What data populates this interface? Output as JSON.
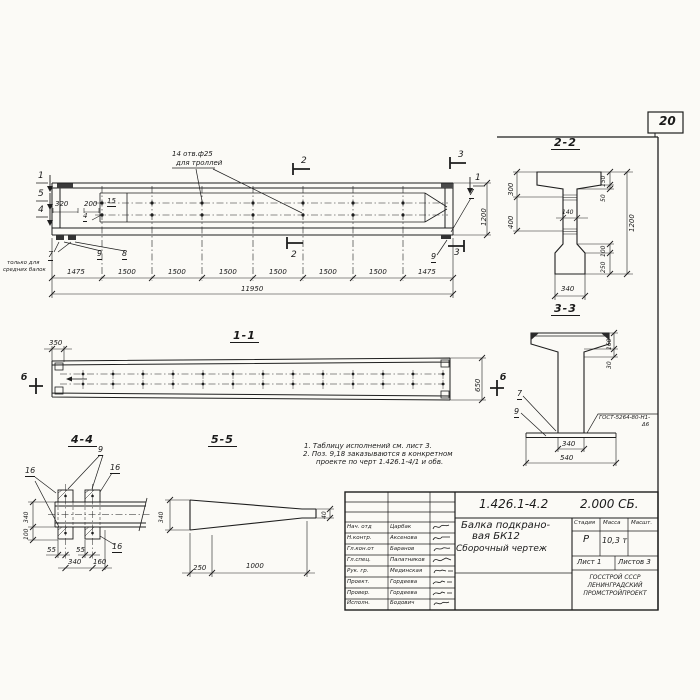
{
  "sheet": {
    "number": "20"
  },
  "notes": {
    "line1": "1. Таблицу исполнений см. лист 3.",
    "line2": "2. Поз. 9,18 заказываются в конкретном",
    "line3": "проекте по черт 1.426.1-4/1 и обв."
  },
  "facade": {
    "callout1": "14 отв.ф25",
    "callout2": "для троллей",
    "sec1": "1",
    "sec5": "5",
    "sec4": "4",
    "sec2": "2",
    "sec3": "3",
    "dim320": "320",
    "dim200": "200",
    "dim1200": "1200",
    "pos15": "15",
    "pos4": "4",
    "pos7l": "7",
    "pos7r": "7",
    "pos8": "8",
    "pos9l": "9",
    "pos9r": "9",
    "note7a": "только для",
    "note7b": "средних балок",
    "segments": [
      "1475",
      "1500",
      "1500",
      "1500",
      "1500",
      "1500",
      "1500",
      "1475"
    ],
    "total": "11950"
  },
  "section22": {
    "title": "2-2",
    "d300": "300",
    "d400": "400",
    "d140": "140",
    "d150": "150",
    "d50": "50",
    "d1200": "1200",
    "d100": "100",
    "d250": "250",
    "d340": "340"
  },
  "section33": {
    "title": "3-3",
    "d160": "160",
    "d30": "30",
    "pos7": "7",
    "pos9": "9",
    "weld1": "ГОСТ-5264-80-Н1-",
    "weld2": "Δ6",
    "d340": "340",
    "d540": "540"
  },
  "view11": {
    "title": "1-1",
    "d350": "350",
    "d650": "650",
    "marker": "б"
  },
  "view44": {
    "title": "4-4",
    "pos9": "9",
    "pos16": "16",
    "d340v": "340",
    "d100": "100",
    "d55": "55",
    "d340h": "340",
    "d160": "160"
  },
  "view55": {
    "title": "5-5",
    "d340": "340",
    "d40": "40",
    "d250": "250",
    "d1000": "1000"
  },
  "titleblock": {
    "doc_number": "1.426.1-4.2",
    "doc_code": "2.000 СБ.",
    "title1": "Балка подкрано-",
    "title2": "вая БК12",
    "title3": "Сборочный чертеж",
    "stage_label": "Стадия",
    "mass_label": "Масса",
    "scale_label": "Масшт.",
    "stage_value": "Р",
    "mass_value": "10,3 т",
    "sheet_label": "Лист 1",
    "sheets_label": "Листов 3",
    "org1": "ГОССТРОЙ СССР",
    "org2": "ЛЕНИНГРАДСКИЙ",
    "org3": "ПРОМСТРОЙПРОЕКТ",
    "rows": [
      {
        "role": "Нач. отд",
        "name": "Царбак"
      },
      {
        "role": "Н.контр.",
        "name": "Аксенова"
      },
      {
        "role": "Гл.кон.от",
        "name": "Баранов"
      },
      {
        "role": "Гл.спец.",
        "name": "Палатников"
      },
      {
        "role": "Рук. гр.",
        "name": "Мединская"
      },
      {
        "role": "Проект.",
        "name": "Гордеева"
      },
      {
        "role": "Провер.",
        "name": "Гордеева"
      },
      {
        "role": "Исполн.",
        "name": "Бодович"
      }
    ]
  }
}
